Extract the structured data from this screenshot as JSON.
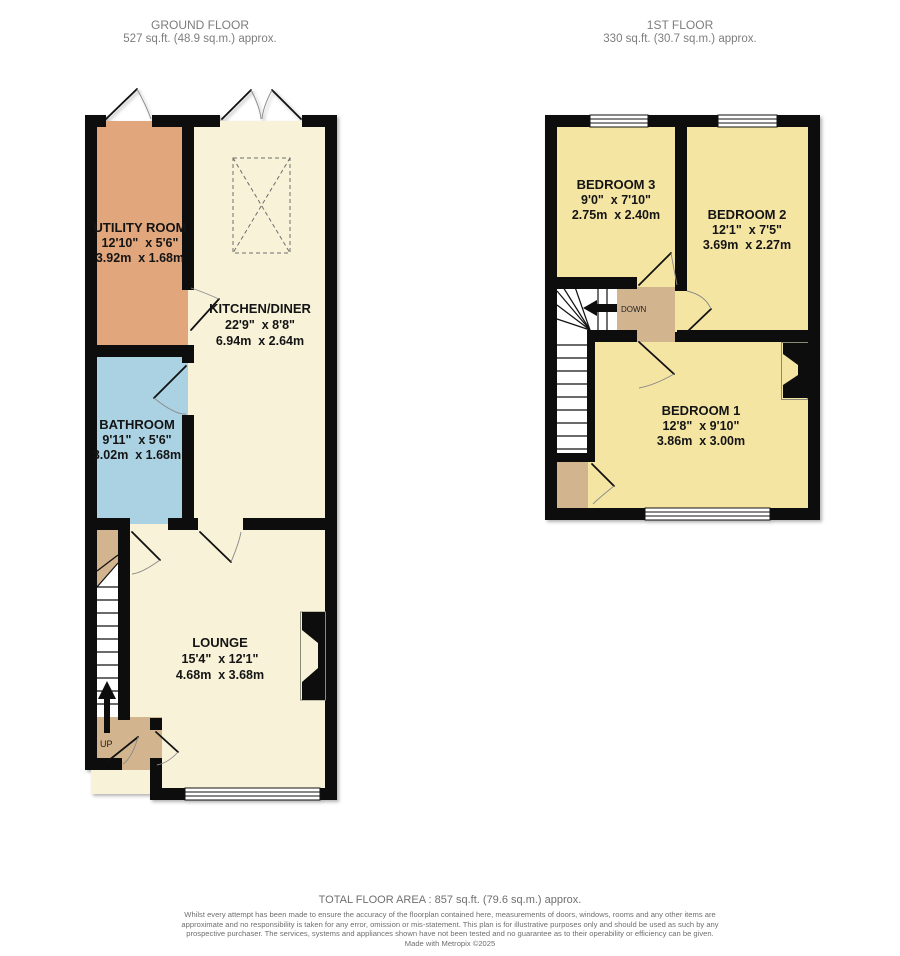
{
  "ground_floor": {
    "title": "GROUND FLOOR",
    "area": "527 sq.ft. (48.9 sq.m.) approx.",
    "rooms": [
      {
        "name": "UTILITY ROOM",
        "imperial": "12'10\"  x 5'6\"",
        "metric": "3.92m  x 1.68m"
      },
      {
        "name": "KITCHEN/DINER",
        "imperial": "22'9\"  x 8'8\"",
        "metric": "6.94m  x 2.64m"
      },
      {
        "name": "BATHROOM",
        "imperial": "9'11\"  x 5'6\"",
        "metric": "3.02m  x 1.68m"
      },
      {
        "name": "LOUNGE",
        "imperial": "15'4\"  x 12'1\"",
        "metric": "4.68m  x 3.68m"
      }
    ],
    "stairs_label": "UP"
  },
  "first_floor": {
    "title": "1ST FLOOR",
    "area": "330 sq.ft. (30.7 sq.m.) approx.",
    "rooms": [
      {
        "name": "BEDROOM 3",
        "imperial": "9'0\"  x 7'10\"",
        "metric": "2.75m  x 2.40m"
      },
      {
        "name": "BEDROOM 2",
        "imperial": "12'1\"  x 7'5\"",
        "metric": "3.69m  x 2.27m"
      },
      {
        "name": "BEDROOM 1",
        "imperial": "12'8\"  x 9'10\"",
        "metric": "3.86m  x 3.00m"
      }
    ],
    "stairs_label": "DOWN"
  },
  "footer": {
    "total_area": "TOTAL FLOOR AREA : 857 sq.ft. (79.6 sq.m.) approx.",
    "disclaimer": "Whilst every attempt has been made to ensure the accuracy of the floorplan contained here, measurements of doors, windows, rooms and any other items are approximate and no responsibility is taken for any error, omission or mis-statement. This plan is for illustrative purposes only and should be used as such by any prospective purchaser. The services, systems and appliances shown have not been tested and no guarantee as to their operability or efficiency can be given.",
    "credit": "Made with Metropix ©2025"
  },
  "colors": {
    "wall": "#0d0d0d",
    "cream_room": "#f7f2d8",
    "utility_room": "#e1a67c",
    "bathroom": "#aad2e3",
    "bedroom": "#f4e5a3",
    "hall_landing": "#d2b48f"
  }
}
